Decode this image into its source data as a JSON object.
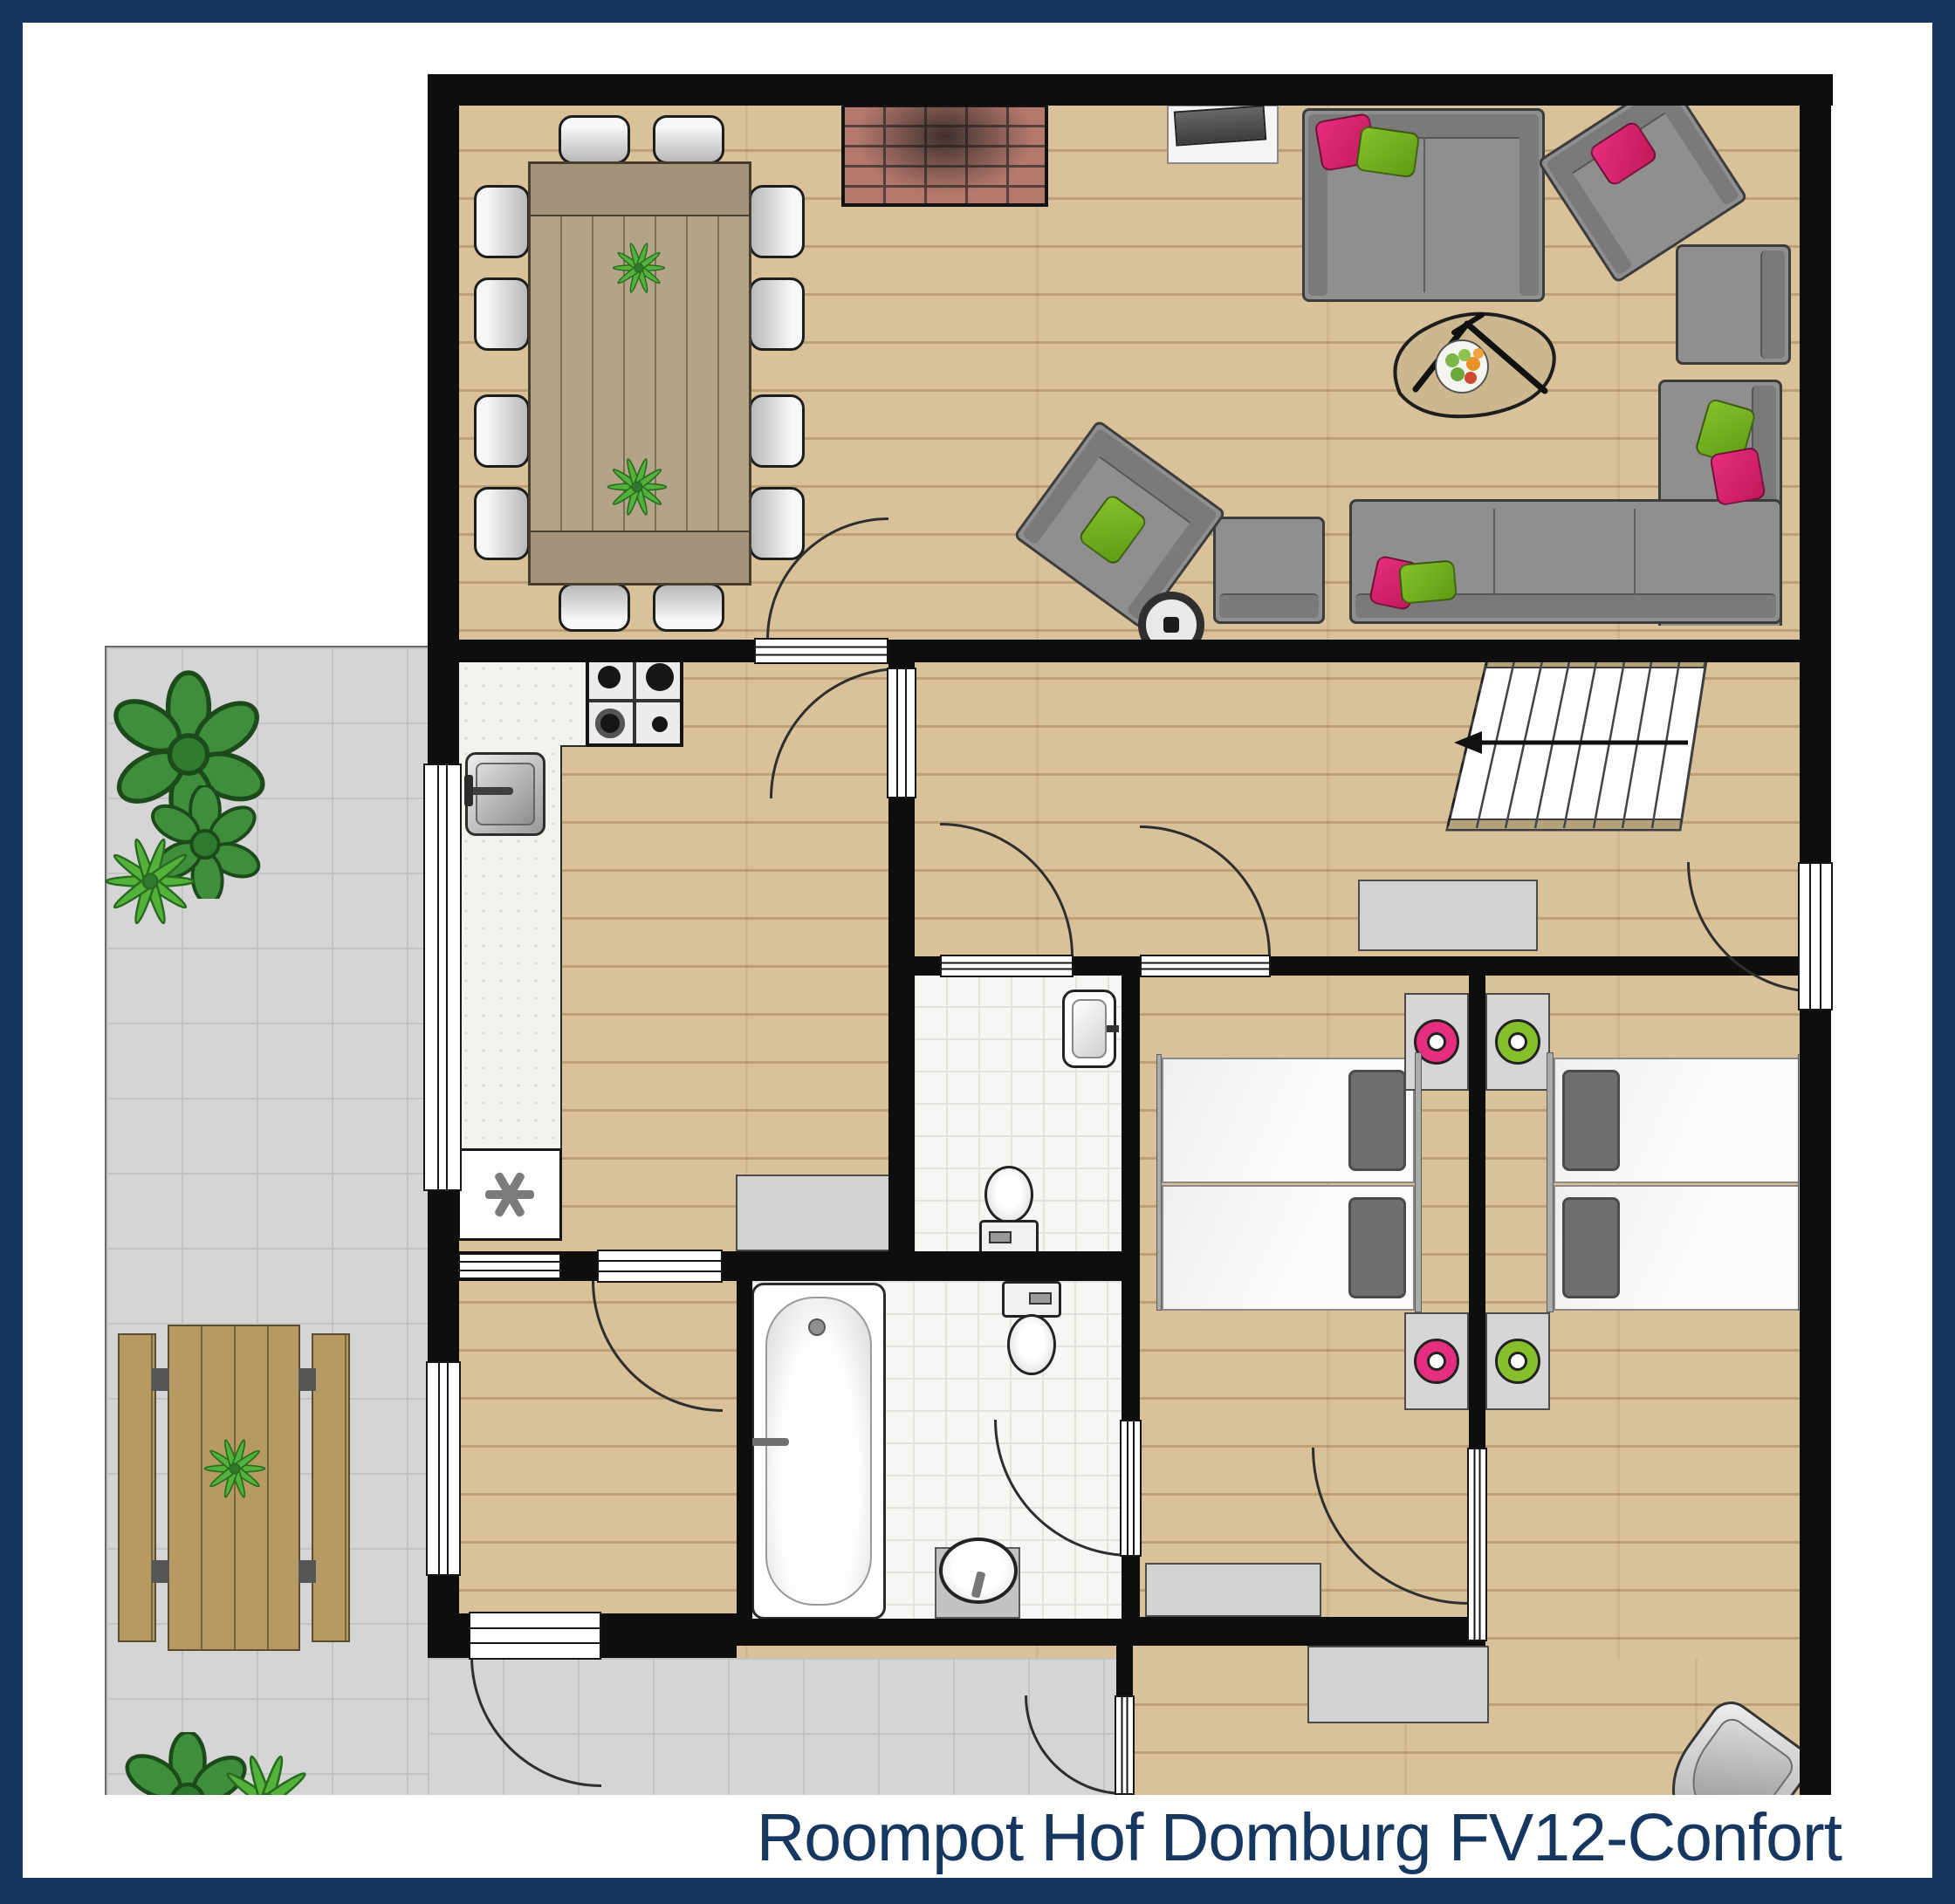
{
  "caption": {
    "text": "Roompot Hof Domburg FV12-Confort"
  },
  "colors": {
    "navy": "#16375f",
    "wall": "#0e0e0e",
    "wood": "#d9c199",
    "terrace": "#d5d5d5",
    "terrace_line": "#c3c3c3",
    "tile": "#f6f6f4",
    "tile_line": "#e3e3de",
    "counter": "#f3f2ec",
    "sofa": "#8f8f8f",
    "sofa_dark": "#7a7a7a",
    "pink": "#e62e7e",
    "green": "#85c02c",
    "plant": "#3f8e3c",
    "brick": "#b4786c",
    "table_wood": "#b3a488",
    "gray_furniture": "#d2d2d2"
  }
}
